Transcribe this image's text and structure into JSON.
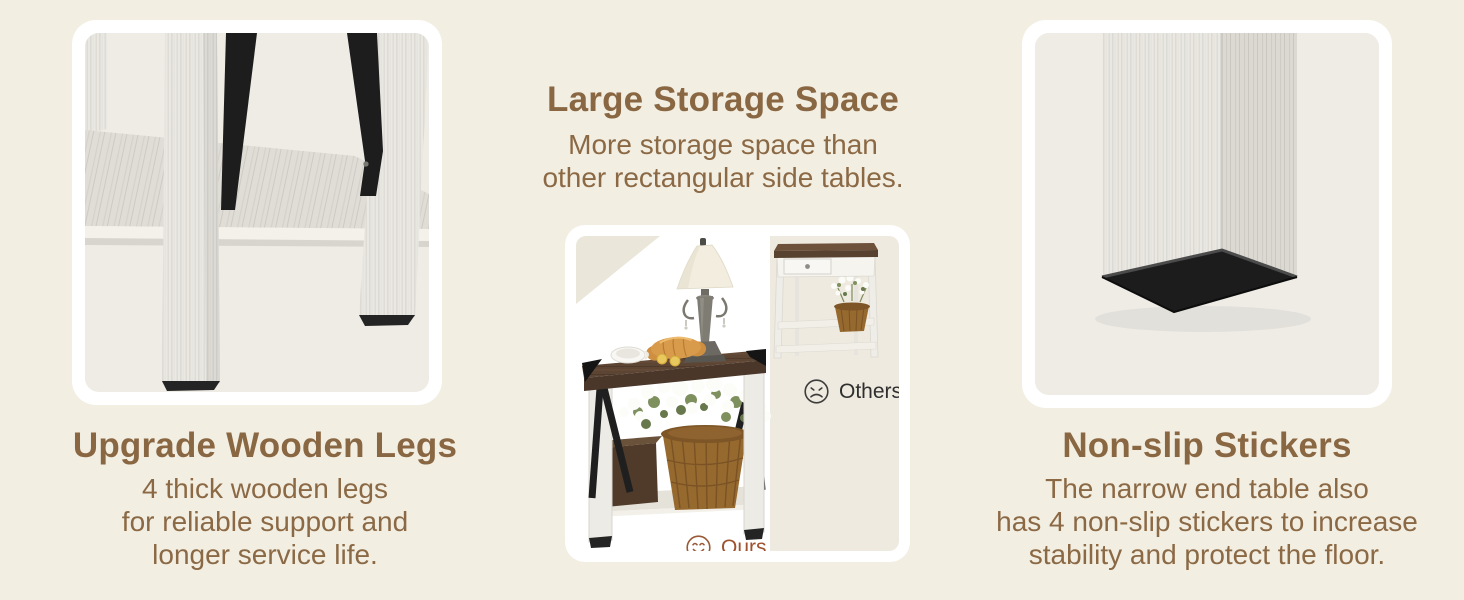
{
  "banner": {
    "type": "product-feature-banner",
    "colors": {
      "page_bg": "#f2eee2",
      "card_bg": "#ffffff",
      "photo_bg": "#efece6",
      "heading_text": "#8a6743",
      "body_text": "#8b6945",
      "ours_accent": "#a0522d",
      "others_text": "#2f2f2f",
      "metal_black": "#1d1d1d",
      "walnut_wood": "#5d4534"
    }
  },
  "left": {
    "heading": "Upgrade Wooden Legs",
    "lines": [
      "4 thick wooden legs",
      "for reliable support and",
      "longer service life."
    ]
  },
  "middle": {
    "heading": "Large Storage Space",
    "lines": [
      "More storage space than",
      "other rectangular side tables."
    ],
    "comparison": {
      "ours_label": "Ours",
      "ours_icon": "smiley-face",
      "others_label": "Others",
      "others_icon": "sad-face"
    }
  },
  "right": {
    "heading": "Non-slip Stickers",
    "lines": [
      "The narrow end table also",
      "has 4 non-slip stickers to increase",
      "stability and protect the floor."
    ]
  }
}
